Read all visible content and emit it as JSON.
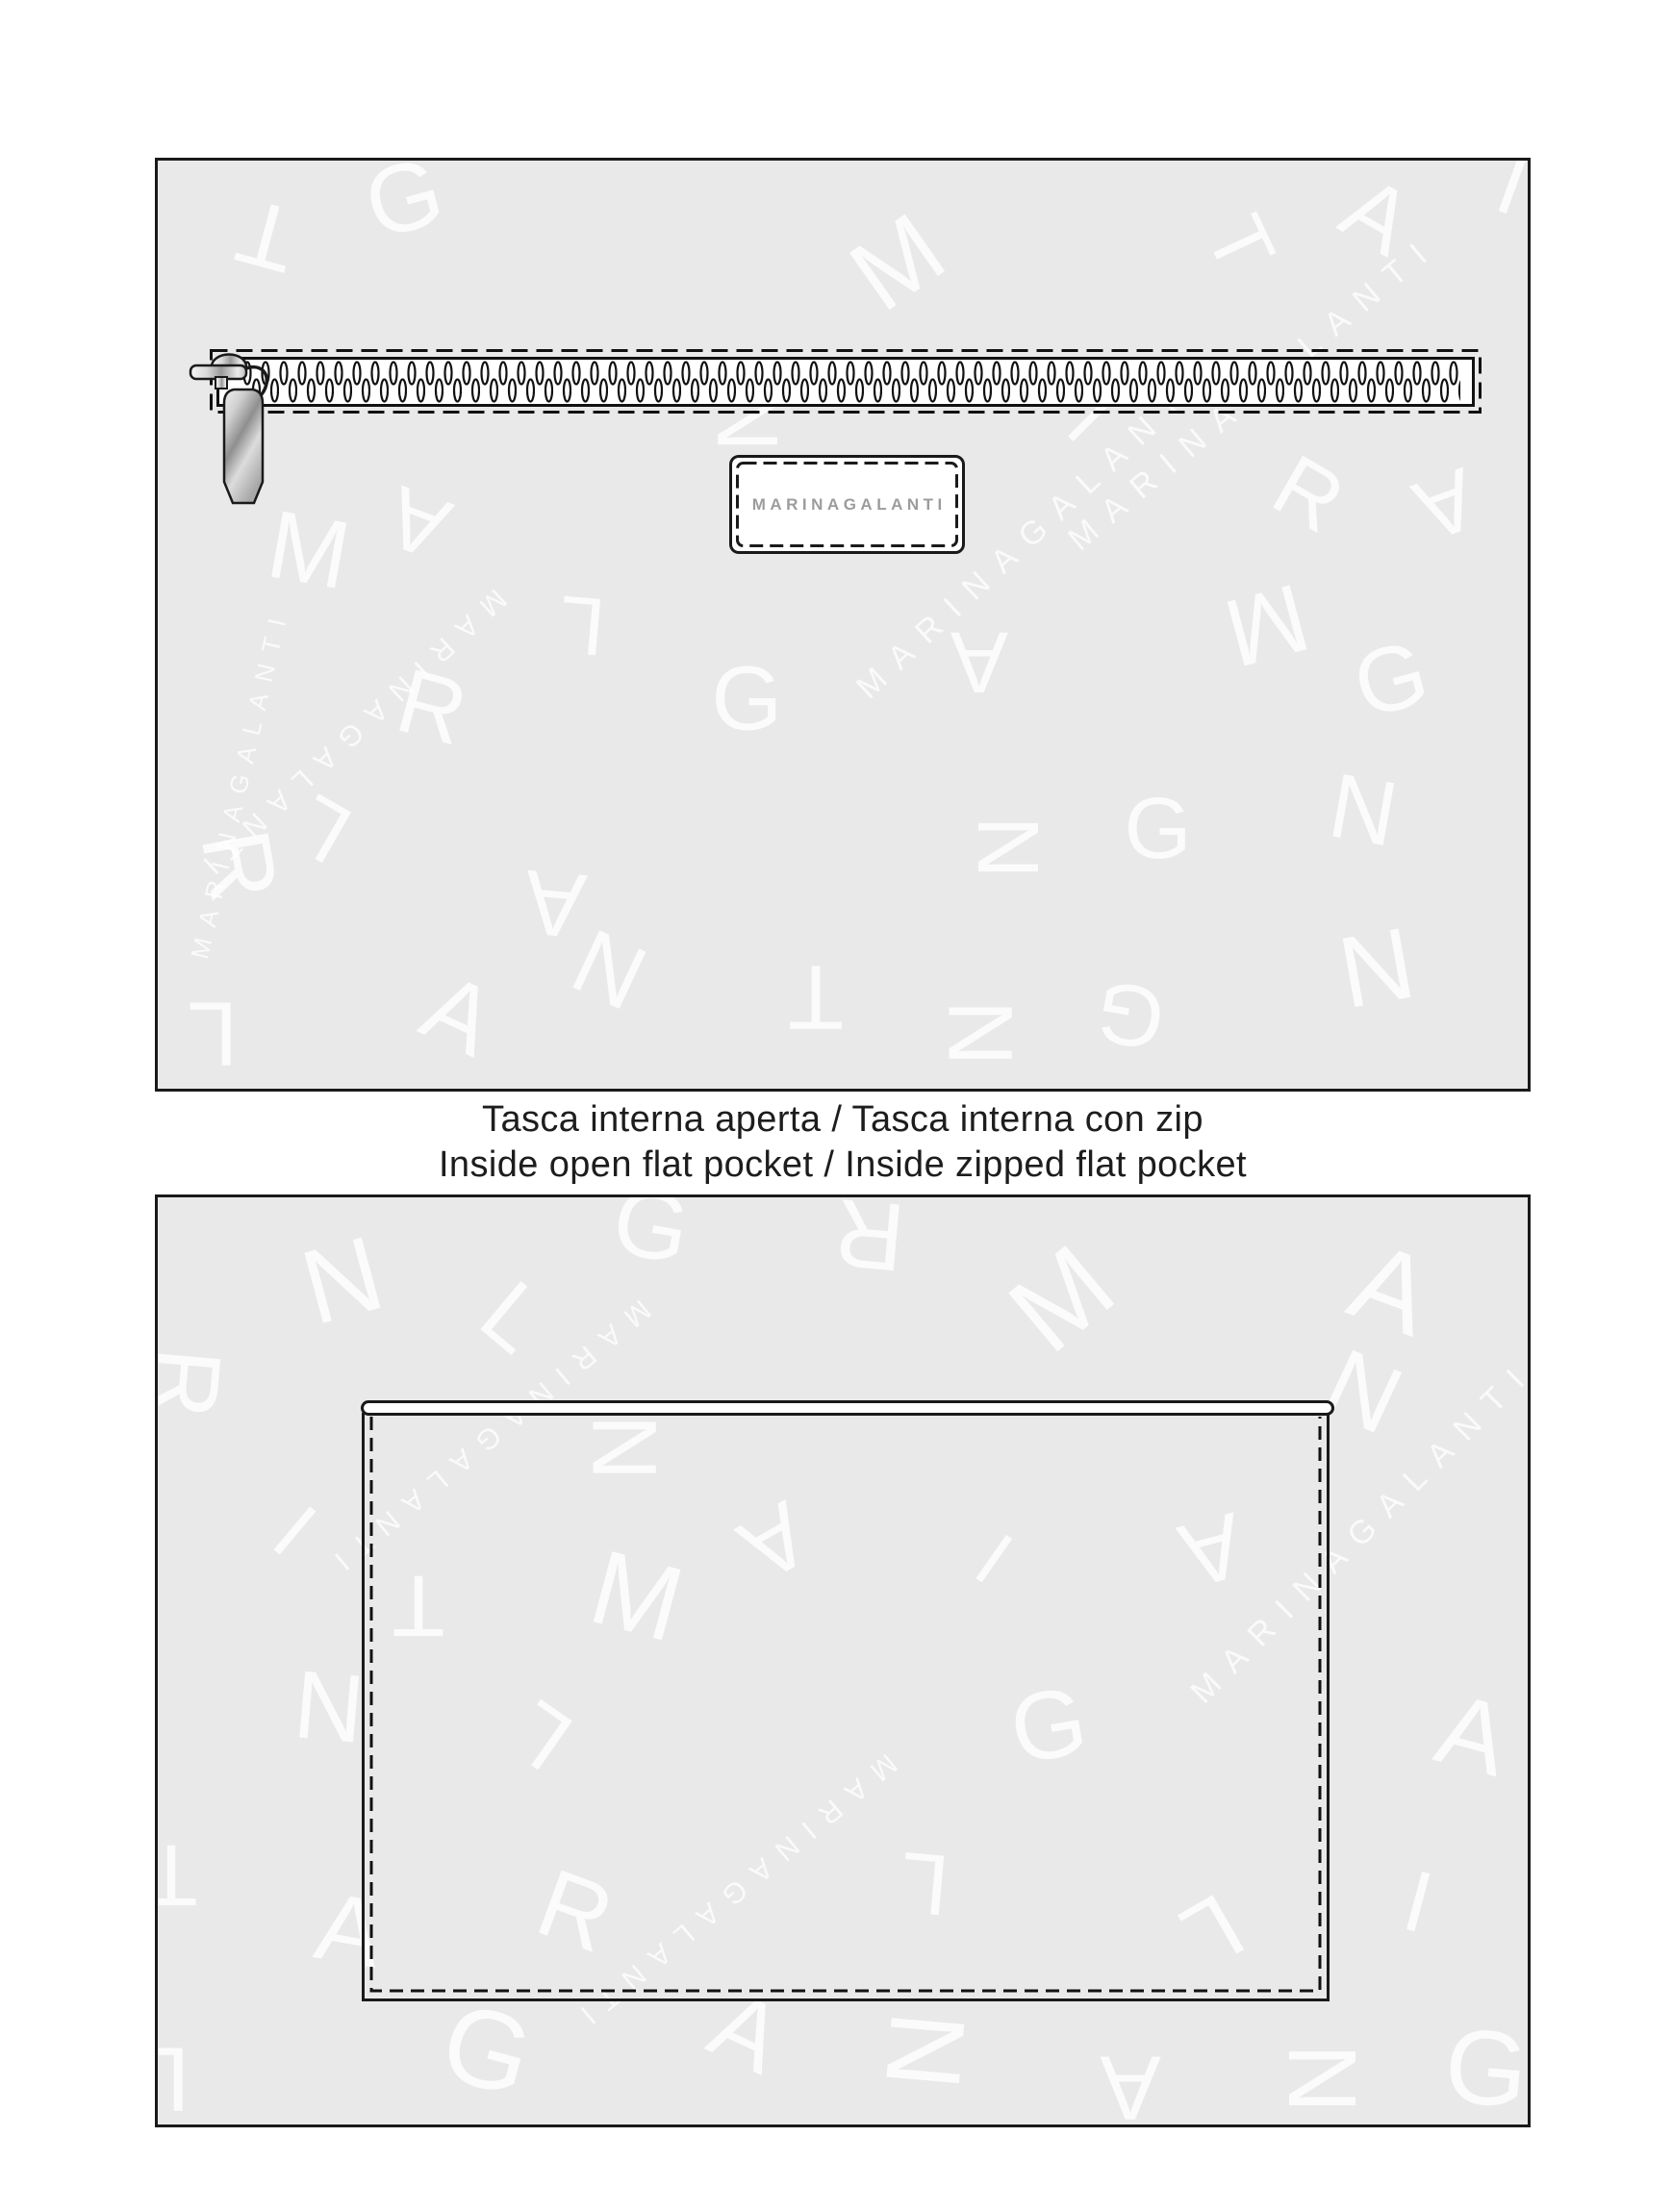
{
  "caption": {
    "line1": "Tasca interna aperta / Tasca interna con zip",
    "line2": "Inside open flat pocket / Inside zipped flat pocket"
  },
  "label_patch": {
    "text": "MARINAGALANTI"
  },
  "colors": {
    "panel_bg": "#e9e9e9",
    "outline": "#1a1a1a",
    "pattern_letter": "#ffffff",
    "label_text": "#9c9c9c",
    "caption_text": "#1d1d1d",
    "metal_light": "#f2f2f2",
    "metal_dark": "#8d8d8d"
  },
  "pattern": {
    "word": "MARINAGALANTI",
    "panels": {
      "top": {
        "letters": [
          {
            "ch": "G",
            "x": 18,
            "y": 4,
            "rot": -15,
            "size": 100
          },
          {
            "ch": "T",
            "x": 8,
            "y": 8,
            "rot": 195,
            "size": 95
          },
          {
            "ch": "M",
            "x": 54,
            "y": 11,
            "rot": -35,
            "size": 105
          },
          {
            "ch": "A",
            "x": 89,
            "y": 6,
            "rot": 30,
            "size": 95
          },
          {
            "ch": "T",
            "x": 79,
            "y": 9,
            "rot": 65,
            "size": 85
          },
          {
            "ch": "L",
            "x": 98,
            "y": 2,
            "rot": 200,
            "size": 90
          },
          {
            "ch": "M",
            "x": 11,
            "y": 42,
            "rot": 10,
            "size": 100
          },
          {
            "ch": "A",
            "x": 19,
            "y": 39,
            "rot": 200,
            "size": 90
          },
          {
            "ch": "N",
            "x": 43,
            "y": 28,
            "rot": 90,
            "size": 90
          },
          {
            "ch": "L",
            "x": 31,
            "y": 50,
            "rot": 185,
            "size": 85
          },
          {
            "ch": "R",
            "x": 20,
            "y": 59,
            "rot": 15,
            "size": 95
          },
          {
            "ch": "L",
            "x": 12,
            "y": 72,
            "rot": 210,
            "size": 88
          },
          {
            "ch": "R",
            "x": 6,
            "y": 76,
            "rot": 80,
            "size": 100
          },
          {
            "ch": "A",
            "x": 29,
            "y": 80,
            "rot": 185,
            "size": 95
          },
          {
            "ch": "A",
            "x": 60,
            "y": 54,
            "rot": 180,
            "size": 90
          },
          {
            "ch": "G",
            "x": 43,
            "y": 58,
            "rot": 0,
            "size": 95
          },
          {
            "ch": "I",
            "x": 68,
            "y": 28,
            "rot": 45,
            "size": 80
          },
          {
            "ch": "R",
            "x": 84,
            "y": 36,
            "rot": 30,
            "size": 90
          },
          {
            "ch": "A",
            "x": 94,
            "y": 37,
            "rot": 160,
            "size": 90
          },
          {
            "ch": "M",
            "x": 81,
            "y": 50,
            "rot": 165,
            "size": 100
          },
          {
            "ch": "G",
            "x": 90,
            "y": 56,
            "rot": -15,
            "size": 95
          },
          {
            "ch": "N",
            "x": 88,
            "y": 70,
            "rot": 10,
            "size": 95
          },
          {
            "ch": "N",
            "x": 62,
            "y": 74,
            "rot": 90,
            "size": 90
          },
          {
            "ch": "G",
            "x": 73,
            "y": 72,
            "rot": 0,
            "size": 90
          },
          {
            "ch": "A",
            "x": 22,
            "y": 92,
            "rot": 25,
            "size": 100
          },
          {
            "ch": "N",
            "x": 33,
            "y": 87,
            "rot": 205,
            "size": 95
          },
          {
            "ch": "T",
            "x": 48,
            "y": 90,
            "rot": 180,
            "size": 95
          },
          {
            "ch": "N",
            "x": 60,
            "y": 94,
            "rot": 90,
            "size": 95
          },
          {
            "ch": "G",
            "x": 71,
            "y": 92,
            "rot": 190,
            "size": 90
          },
          {
            "ch": "N",
            "x": 89,
            "y": 87,
            "rot": -10,
            "size": 105
          },
          {
            "ch": "L",
            "x": 4,
            "y": 94,
            "rot": 180,
            "size": 95
          }
        ],
        "words": [
          {
            "x": 80,
            "y": 25,
            "rot": -40,
            "size": 34,
            "flip": false
          },
          {
            "x": 64,
            "y": 40,
            "rot": -43,
            "size": 34,
            "flip": false
          },
          {
            "x": 14,
            "y": 62,
            "rot": 137,
            "size": 30,
            "flip": false
          },
          {
            "x": 6,
            "y": 67,
            "rot": 283,
            "size": 26,
            "flip": false
          },
          {
            "x": -7,
            "y": 29,
            "rot": 100,
            "size": 36,
            "flip": false
          }
        ]
      },
      "bottom": {
        "letters": [
          {
            "ch": "N",
            "x": 13.5,
            "y": 9,
            "rot": -15,
            "size": 110
          },
          {
            "ch": "L",
            "x": 26,
            "y": 13,
            "rot": 40,
            "size": 95
          },
          {
            "ch": "G",
            "x": 36,
            "y": 3,
            "rot": 10,
            "size": 100
          },
          {
            "ch": "R",
            "x": 52,
            "y": 4,
            "rot": 185,
            "size": 100
          },
          {
            "ch": "M",
            "x": 66,
            "y": 11,
            "rot": -40,
            "size": 115
          },
          {
            "ch": "A",
            "x": 90,
            "y": 10,
            "rot": 20,
            "size": 115
          },
          {
            "ch": "N",
            "x": 88,
            "y": 21,
            "rot": 25,
            "size": 100
          },
          {
            "ch": "R",
            "x": 2,
            "y": 20,
            "rot": 95,
            "size": 100
          },
          {
            "ch": "I",
            "x": 10,
            "y": 36,
            "rot": 40,
            "size": 85
          },
          {
            "ch": "T",
            "x": 19,
            "y": 44,
            "rot": 180,
            "size": 90
          },
          {
            "ch": "M",
            "x": 35,
            "y": 43,
            "rot": 15,
            "size": 110
          },
          {
            "ch": "N",
            "x": 34,
            "y": 27,
            "rot": 90,
            "size": 95
          },
          {
            "ch": "A",
            "x": 45,
            "y": 37,
            "rot": 150,
            "size": 95
          },
          {
            "ch": "I",
            "x": 61,
            "y": 39,
            "rot": 35,
            "size": 80
          },
          {
            "ch": "A",
            "x": 77,
            "y": 38,
            "rot": 165,
            "size": 95
          },
          {
            "ch": "N",
            "x": 12.5,
            "y": 55,
            "rot": 5,
            "size": 100
          },
          {
            "ch": "L",
            "x": 28,
            "y": 58,
            "rot": 215,
            "size": 90
          },
          {
            "ch": "G",
            "x": 65,
            "y": 57,
            "rot": -10,
            "size": 100
          },
          {
            "ch": "A",
            "x": 96,
            "y": 58,
            "rot": 15,
            "size": 105
          },
          {
            "ch": "T",
            "x": 1,
            "y": 73,
            "rot": 180,
            "size": 90
          },
          {
            "ch": "A",
            "x": 14,
            "y": 79,
            "rot": 10,
            "size": 100
          },
          {
            "ch": "R",
            "x": 30.5,
            "y": 77,
            "rot": 20,
            "size": 100
          },
          {
            "ch": "L",
            "x": 56,
            "y": 74,
            "rot": 185,
            "size": 90
          },
          {
            "ch": "L",
            "x": 77,
            "y": 79,
            "rot": 150,
            "size": 95
          },
          {
            "ch": "I",
            "x": 92,
            "y": 76,
            "rot": 15,
            "size": 90
          },
          {
            "ch": "G",
            "x": 24,
            "y": 92,
            "rot": 15,
            "size": 115
          },
          {
            "ch": "A",
            "x": 43,
            "y": 90,
            "rot": 25,
            "size": 100
          },
          {
            "ch": "N",
            "x": 56,
            "y": 92,
            "rot": 95,
            "size": 110
          },
          {
            "ch": "A",
            "x": 71,
            "y": 96,
            "rot": 180,
            "size": 95
          },
          {
            "ch": "N",
            "x": 85,
            "y": 95,
            "rot": 90,
            "size": 100
          },
          {
            "ch": "G",
            "x": 97,
            "y": 94,
            "rot": 5,
            "size": 110
          },
          {
            "ch": "L",
            "x": 0.5,
            "y": 95,
            "rot": 180,
            "size": 95
          }
        ],
        "words": [
          {
            "x": 88,
            "y": 36,
            "rot": -45,
            "size": 34,
            "flip": false
          },
          {
            "x": 24,
            "y": 26,
            "rot": 140,
            "size": 30,
            "flip": false
          },
          {
            "x": 42,
            "y": 75,
            "rot": 140,
            "size": 30,
            "flip": false
          }
        ]
      }
    }
  }
}
